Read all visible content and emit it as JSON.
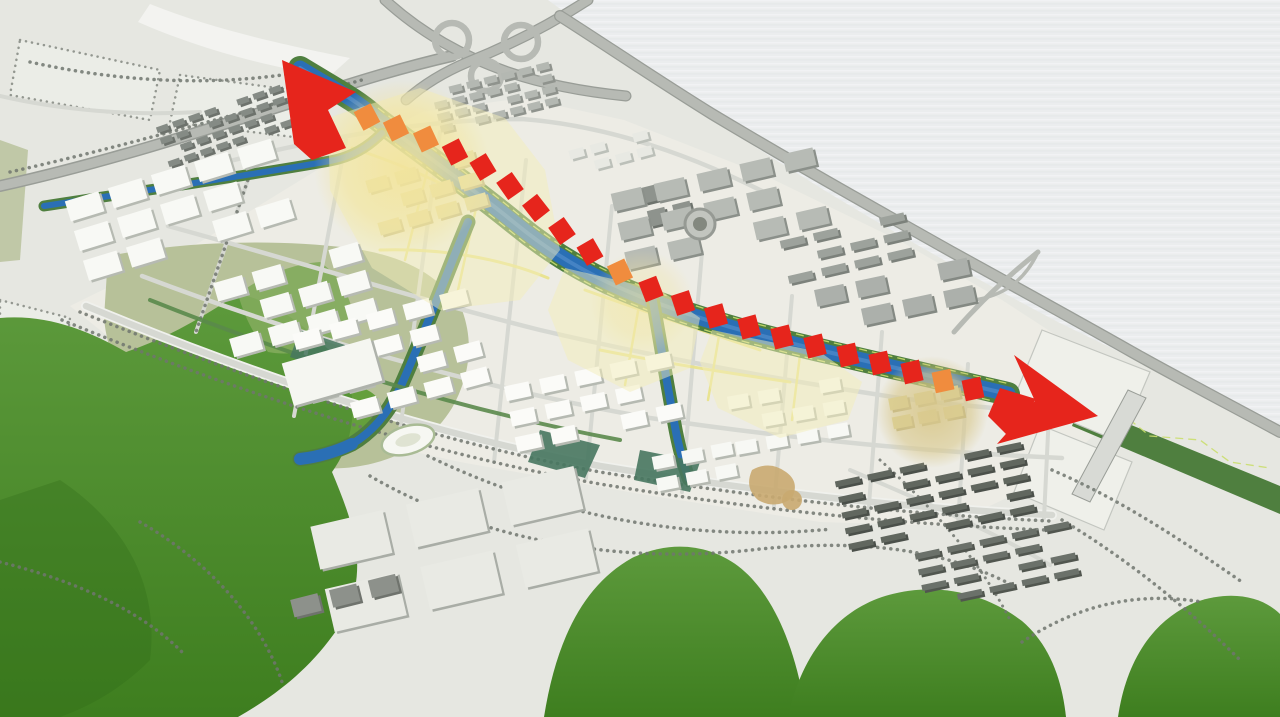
{
  "colors": {
    "bg": "#ebedee",
    "bg_streak_light": "#f7f8f9",
    "bg_streak_dark": "#dee1e3",
    "ground": "#e6e7e1",
    "ground_city": "#edece5",
    "hill_top": "#5d9a3c",
    "hill_bottom": "#3e7e1f",
    "hill_light": "#82ab5c",
    "park_olive": "#b7c199",
    "park_blob": "#5f9d37",
    "green_bank": "#4f7f3f",
    "park_strip": "#5a8a4b",
    "park_teal": "#47775f",
    "water": "#2a6fb5",
    "water_light": "#5b94d0",
    "bank_path": "#cade6e",
    "road": "#d6d8d2",
    "road_casing": "#f0f1ed",
    "street_yellow": "#e9e388",
    "highway": "#b7bab4",
    "highway_edge": "#999d97",
    "tree_dot": "#70766e",
    "bldg_white": "#fafaf7",
    "bldg_side": "#b3b7b0",
    "zone_yellow": "#f3edb9",
    "glow": "#f2e49c",
    "glow_tan": "#d9c98e",
    "route_red": "#e6251c",
    "route_orange": "#f08c3e",
    "slab": "#d8dad5",
    "parcel": "#eff0ea",
    "parcel_edge": "#c3c6c0",
    "tan_plaza": "#c9aa70"
  },
  "scene": {
    "route": {
      "dash_w": 19,
      "dash_h": 21,
      "dashes": [
        {
          "x": 367,
          "y": 117,
          "a": -28,
          "c": "o"
        },
        {
          "x": 396,
          "y": 128,
          "a": -26,
          "c": "o"
        },
        {
          "x": 426,
          "y": 139,
          "a": -25,
          "c": "o"
        },
        {
          "x": 455,
          "y": 152,
          "a": -27,
          "c": "r"
        },
        {
          "x": 483,
          "y": 167,
          "a": -31,
          "c": "r"
        },
        {
          "x": 510,
          "y": 186,
          "a": -35,
          "c": "r"
        },
        {
          "x": 536,
          "y": 208,
          "a": -38,
          "c": "r"
        },
        {
          "x": 562,
          "y": 231,
          "a": -35,
          "c": "r"
        },
        {
          "x": 590,
          "y": 252,
          "a": -30,
          "c": "r"
        },
        {
          "x": 620,
          "y": 272,
          "a": -25,
          "c": "o"
        },
        {
          "x": 651,
          "y": 289,
          "a": -21,
          "c": "r"
        },
        {
          "x": 683,
          "y": 303,
          "a": -18,
          "c": "r"
        },
        {
          "x": 716,
          "y": 316,
          "a": -16,
          "c": "r"
        },
        {
          "x": 749,
          "y": 327,
          "a": -15,
          "c": "r"
        },
        {
          "x": 782,
          "y": 337,
          "a": -14,
          "c": "r"
        },
        {
          "x": 815,
          "y": 346,
          "a": -14,
          "c": "r"
        },
        {
          "x": 848,
          "y": 355,
          "a": -13,
          "c": "r"
        },
        {
          "x": 880,
          "y": 363,
          "a": -13,
          "c": "r"
        },
        {
          "x": 912,
          "y": 372,
          "a": -13,
          "c": "r"
        },
        {
          "x": 943,
          "y": 381,
          "a": -12,
          "c": "o"
        },
        {
          "x": 973,
          "y": 389,
          "a": -12,
          "c": "r"
        }
      ]
    },
    "building_clusters": [
      {
        "name": "rowhouses-nw",
        "cx": 228,
        "cy": 128,
        "cols": 8,
        "rows": 4,
        "gx": 17,
        "gy": 12,
        "bw": 12,
        "bh": 6,
        "angle": -19,
        "fill": "#858b85",
        "side": "#6d726c"
      },
      {
        "name": "rowhouses-n",
        "cx": 498,
        "cy": 99,
        "cols": 7,
        "rows": 4,
        "gx": 18,
        "gy": 12,
        "bw": 13,
        "bh": 7,
        "angle": -14,
        "fill": "#b4b8b2",
        "side": "#8f938d"
      },
      {
        "name": "white-slabs-west",
        "cx": 186,
        "cy": 213,
        "cols": 5,
        "rows": 3,
        "gx": 45,
        "gy": 31,
        "bw": 35,
        "bh": 21,
        "angle": -17,
        "fill": "#f8f9f5",
        "side": "#b6bab2"
      },
      {
        "name": "white-mid-west",
        "cx": 302,
        "cy": 303,
        "cols": 4,
        "rows": 3,
        "gx": 40,
        "gy": 29,
        "bw": 30,
        "bh": 19,
        "angle": -16,
        "fill": "#f8f9f5",
        "side": "#b6bab2"
      },
      {
        "name": "tan-node-west",
        "cx": 432,
        "cy": 196,
        "cols": 4,
        "rows": 3,
        "gx": 30,
        "gy": 22,
        "bw": 22,
        "bh": 13,
        "angle": -16,
        "fill": "#ddd396",
        "side": "#b2a878"
      },
      {
        "name": "white-core-south",
        "cx": 398,
        "cy": 362,
        "cols": 5,
        "rows": 4,
        "gx": 38,
        "gy": 27,
        "bw": 27,
        "bh": 16,
        "angle": -15,
        "fill": "#fbfbf8",
        "side": "#b6bab2"
      },
      {
        "name": "white-core-mid",
        "cx": 600,
        "cy": 406,
        "cols": 5,
        "rows": 3,
        "gx": 36,
        "gy": 26,
        "bw": 25,
        "bh": 15,
        "angle": -12,
        "fill": "#fbfbf8",
        "side": "#b6bab2"
      },
      {
        "name": "white-ne-small",
        "cx": 615,
        "cy": 155,
        "cols": 4,
        "rows": 2,
        "gx": 22,
        "gy": 16,
        "bw": 15,
        "bh": 9,
        "angle": -15,
        "fill": "#e8e9e3",
        "side": "#bcc0b9"
      },
      {
        "name": "gray-tall-mid",
        "cx": 672,
        "cy": 205,
        "cols": 2,
        "rows": 2,
        "gx": 26,
        "gy": 24,
        "bw": 18,
        "bh": 16,
        "angle": -14,
        "fill": "#8e938d",
        "side": "#6e736d"
      },
      {
        "name": "gray-north-1",
        "cx": 728,
        "cy": 213,
        "cols": 5,
        "rows": 3,
        "gx": 44,
        "gy": 30,
        "bw": 31,
        "bh": 18,
        "angle": -13,
        "fill": "#b7bbb5",
        "side": "#8b908a"
      },
      {
        "name": "gray-north-rows",
        "cx": 852,
        "cy": 252,
        "cols": 4,
        "rows": 3,
        "gx": 34,
        "gy": 18,
        "bw": 25,
        "bh": 8,
        "angle": -13,
        "fill": "#9da29c",
        "side": "#7c817b"
      },
      {
        "name": "gray-north-2",
        "cx": 902,
        "cy": 300,
        "cols": 4,
        "rows": 2,
        "gx": 42,
        "gy": 28,
        "bw": 30,
        "bh": 17,
        "angle": -12,
        "fill": "#acb0ab",
        "side": "#848983"
      },
      {
        "name": "white-node-east",
        "cx": 794,
        "cy": 420,
        "cols": 4,
        "rows": 3,
        "gx": 31,
        "gy": 23,
        "bw": 21,
        "bh": 13,
        "angle": -10,
        "fill": "#f7f8f4",
        "side": "#b6bab2"
      },
      {
        "name": "tan-node-east",
        "cx": 930,
        "cy": 410,
        "cols": 3,
        "rows": 2,
        "gx": 26,
        "gy": 19,
        "bw": 19,
        "bh": 12,
        "angle": -11,
        "fill": "#ddd396",
        "side": "#b2a878"
      },
      {
        "name": "white-south-mid",
        "cx": 700,
        "cy": 470,
        "cols": 3,
        "rows": 2,
        "gx": 30,
        "gy": 22,
        "bw": 21,
        "bh": 13,
        "angle": -11,
        "fill": "#f7f8f4",
        "side": "#b6bab2"
      },
      {
        "name": "rows-southeast-1",
        "cx": 940,
        "cy": 500,
        "cols": 6,
        "rows": 5,
        "gx": 33,
        "gy": 16,
        "bw": 25,
        "bh": 6,
        "angle": -12,
        "fill": "#61675f",
        "side": "#4b504a"
      },
      {
        "name": "rows-southeast-2",
        "cx": 1002,
        "cy": 568,
        "cols": 5,
        "rows": 4,
        "gx": 33,
        "gy": 16,
        "bw": 25,
        "bh": 6,
        "angle": -12,
        "fill": "#6b716a",
        "side": "#51564f"
      },
      {
        "name": "bigbox-foreground",
        "cx": 468,
        "cy": 556,
        "cols": 3,
        "rows": 2,
        "gx": 98,
        "gy": 64,
        "bw": 74,
        "bh": 44,
        "angle": -13,
        "fill": "#e9eae4",
        "side": "#a9ada6"
      },
      {
        "name": "fg-dark-sheds",
        "cx": 352,
        "cy": 600,
        "cols": 3,
        "rows": 1,
        "gx": 40,
        "gy": 30,
        "bw": 28,
        "bh": 18,
        "angle": -14,
        "fill": "#8d918b",
        "side": "#6f736d"
      }
    ]
  }
}
